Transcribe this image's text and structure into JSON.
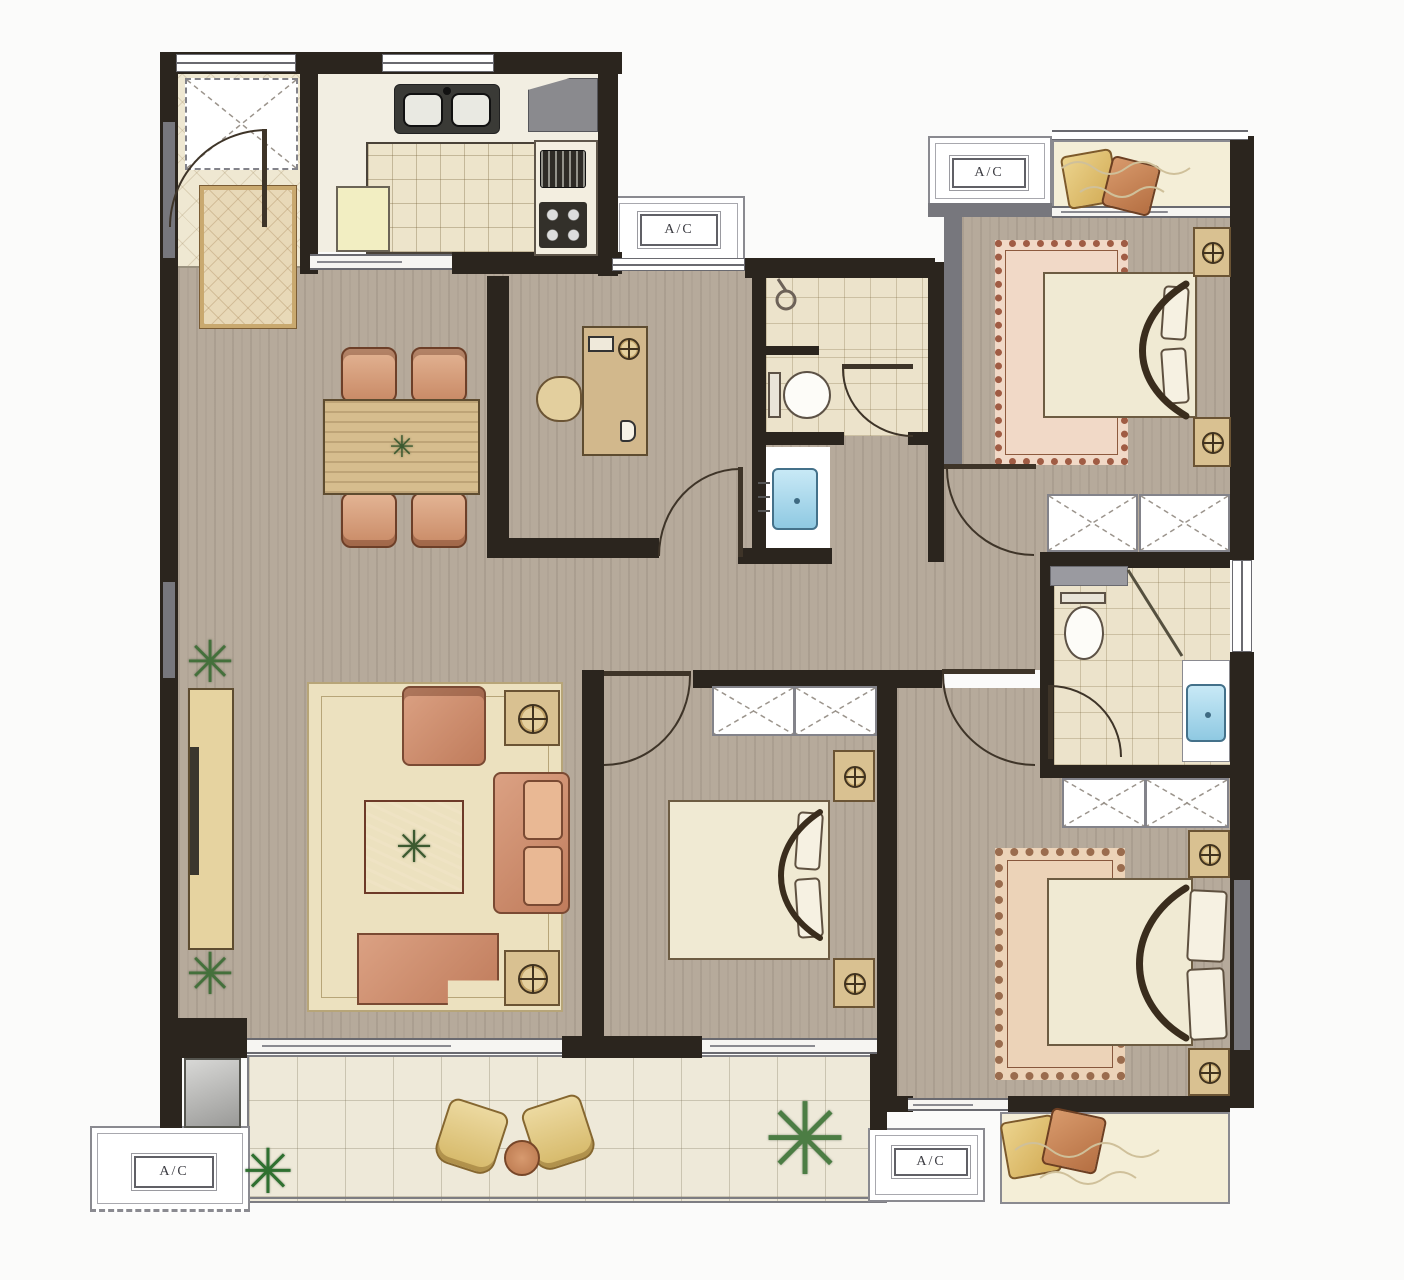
{
  "floorplan": {
    "ac_labels": {
      "top_middle": "A/C",
      "top_right": "A/C",
      "bottom_left": "A/C",
      "bottom_right": "A/C"
    },
    "icons": {
      "plant": "✳"
    },
    "colors": {
      "wall_dark": "#2b251e",
      "wall_gray": "#77777d",
      "wood_floor": "#b6aa9b",
      "tile_cream": "#ece3cb",
      "balcony_tile": "#eee9d9",
      "marble": "#f4eed7",
      "living_rug": "#ece1bf",
      "sofa_terracotta": "#c07c5c",
      "coffee_table": "#b35f47",
      "bed_linen": "#f0ead3",
      "bedroom_rug": "#f1d9c7",
      "master_rug": "#ecd3b8",
      "sink_blue": "#8fc9e2",
      "plant_green": "#44703b",
      "furniture_tan": "#d9c191"
    }
  }
}
